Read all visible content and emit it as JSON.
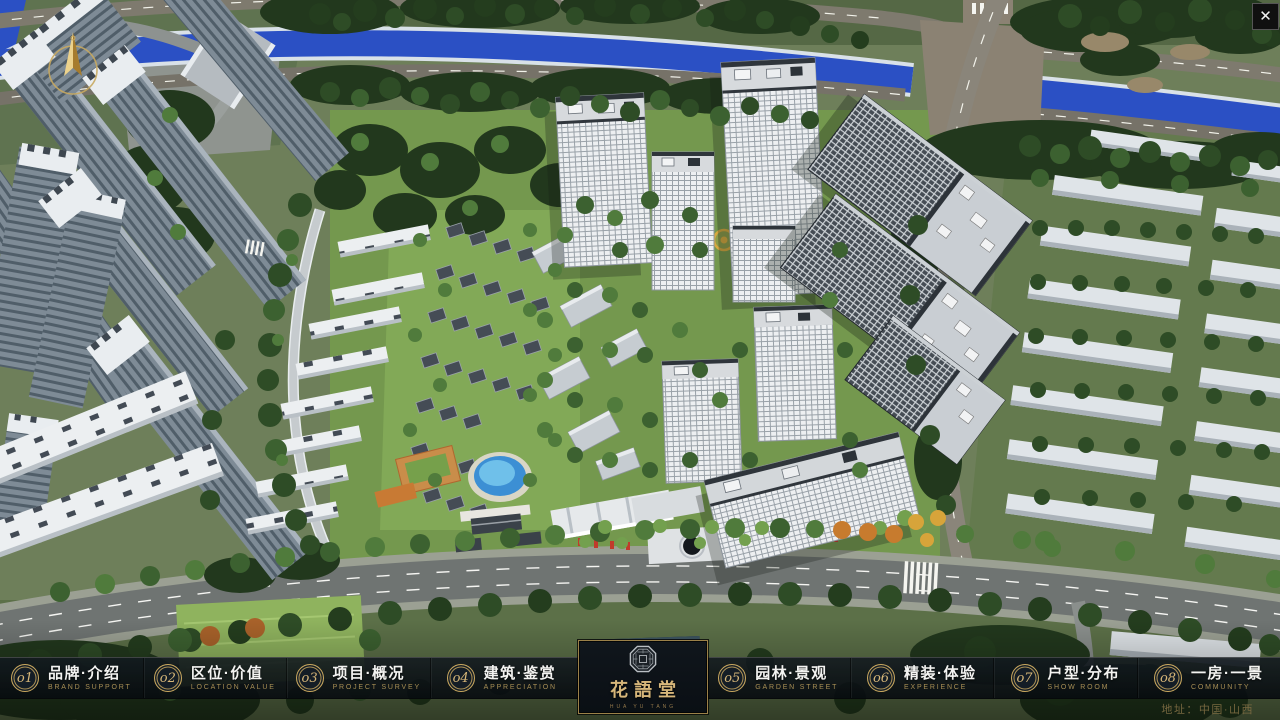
{
  "nav": {
    "items": [
      {
        "num": "o1",
        "zh": "品牌·介绍",
        "en": "BRAND SUPPORT"
      },
      {
        "num": "o2",
        "zh": "区位·价值",
        "en": "LOCATION VALUE"
      },
      {
        "num": "o3",
        "zh": "项目·概况",
        "en": "PROJECT SURVEY"
      },
      {
        "num": "o4",
        "zh": "建筑·鉴赏",
        "en": "APPRECIATION"
      },
      {
        "num": "o5",
        "zh": "园林·景观",
        "en": "GARDEN STREET"
      },
      {
        "num": "o6",
        "zh": "精装·体验",
        "en": "EXPERIENCE"
      },
      {
        "num": "o7",
        "zh": "户型·分布",
        "en": "SHOW ROOM"
      },
      {
        "num": "o8",
        "zh": "一房·一景",
        "en": "COMMUNITY"
      }
    ]
  },
  "logo": {
    "title": "花語堂",
    "subtitle": "HUA YU TANG"
  },
  "footer": {
    "address": "地址：中国·山西"
  },
  "window": {
    "close_glyph": "✕"
  },
  "colors": {
    "gold": "#c9a85f",
    "bar_bg": "#0d141a",
    "river_blue": "#2b50c4"
  }
}
